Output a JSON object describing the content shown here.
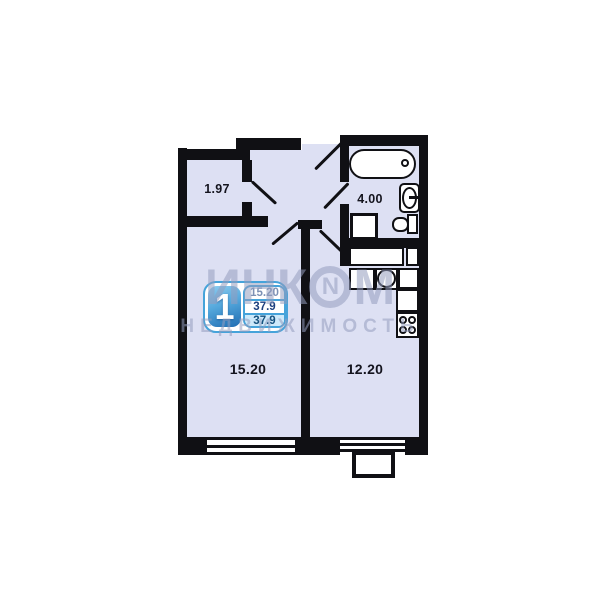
{
  "plan": {
    "labels": {
      "hallway": "1.97",
      "bathroom": "4.00",
      "living_room": "15.20",
      "kitchen": "12.20"
    },
    "colors": {
      "wall": "#101014",
      "room_fill": "#dde0f3",
      "fixture_fill": "#ffffff",
      "label_text": "#14141e",
      "accent": "#45a3da",
      "watermark": "rgba(148,157,190,0.55)"
    }
  },
  "legend_badge": {
    "number": "1",
    "rows": [
      "15.20",
      "37.9",
      "37.9"
    ]
  },
  "watermark": {
    "brand_pre": "ИНК",
    "brand_o": "N",
    "brand_post": "М",
    "subtitle": "НЕДВИЖИМОСТЬ"
  }
}
